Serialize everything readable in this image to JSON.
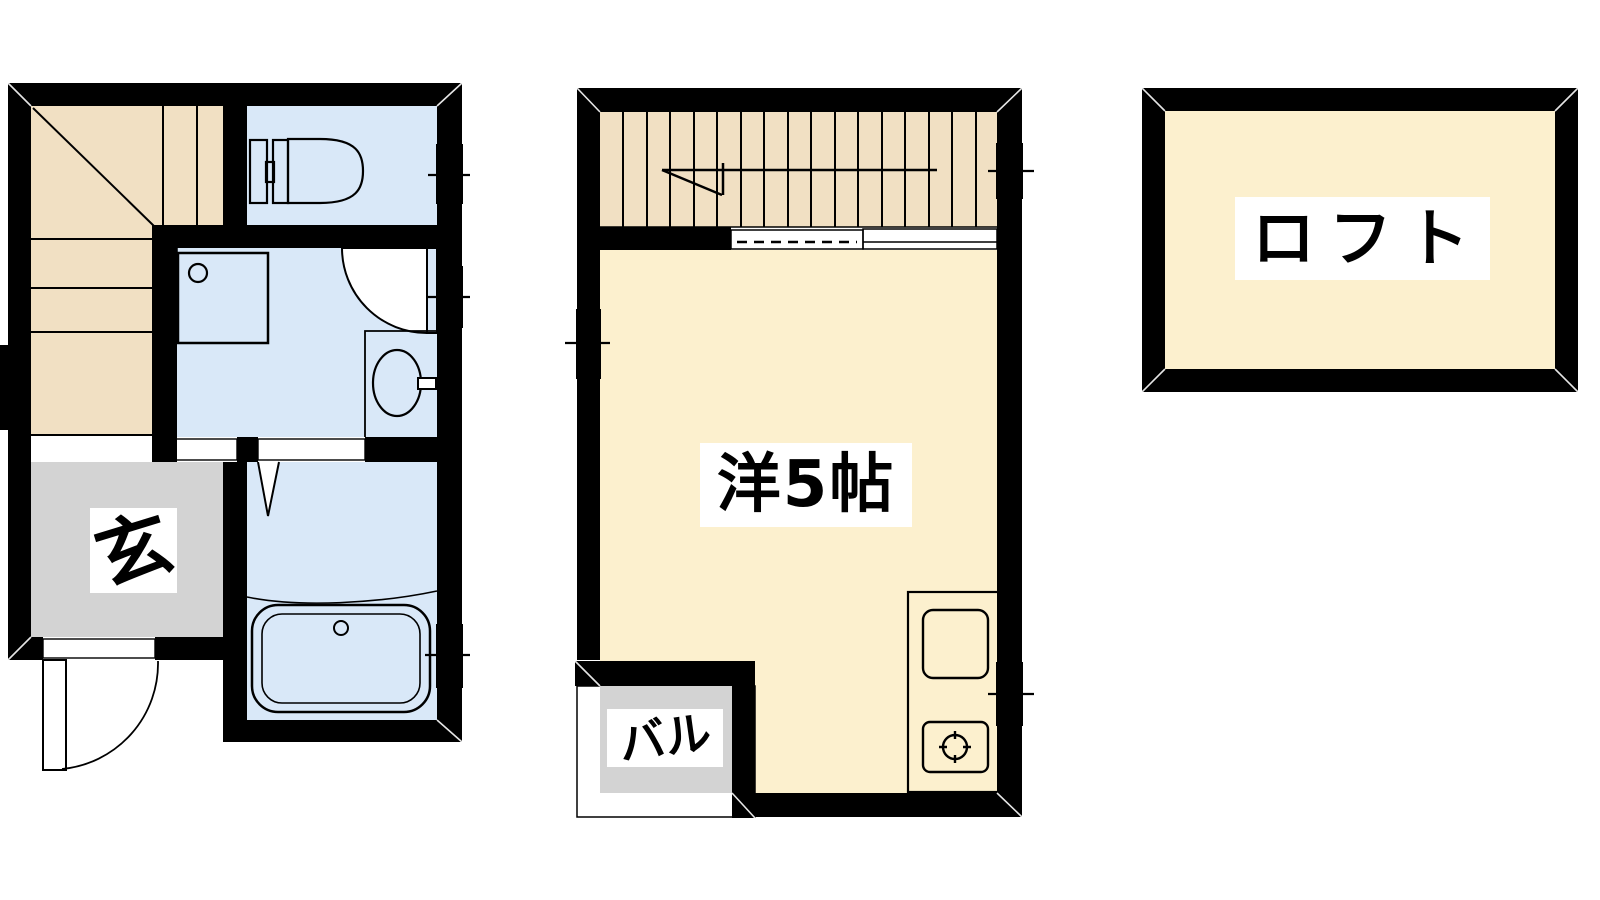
{
  "labels": {
    "entrance": "玄",
    "main_room": "洋5帖",
    "balcony": "バル",
    "loft": "ロフト"
  },
  "colors": {
    "wall": "#000000",
    "stairs_floor": "#f1e0c3",
    "wet_area_floor": "#d9e8f8",
    "room_floor": "#fcf0ce",
    "entrance_floor": "#d3d3d3",
    "kitchen_counter": "#eadff3",
    "background": "#ffffff",
    "label_background": "#ffffff",
    "label_text": "#000000"
  },
  "fixtures": {
    "first_floor": [
      "winder-staircase",
      "toilet",
      "shower-tray",
      "washbasin",
      "bathtub",
      "entry-door-swing",
      "interior-door-swing",
      "folding-door-mark",
      "accordion-door-dashed",
      "sliding-door",
      "windows-x3"
    ],
    "second_floor": [
      "staircase",
      "stair-direction-arrow",
      "handrail-dashed",
      "kitchen-sink",
      "stove-burner",
      "balcony",
      "windows-x3"
    ],
    "loft": [
      "open-loft-space"
    ]
  }
}
